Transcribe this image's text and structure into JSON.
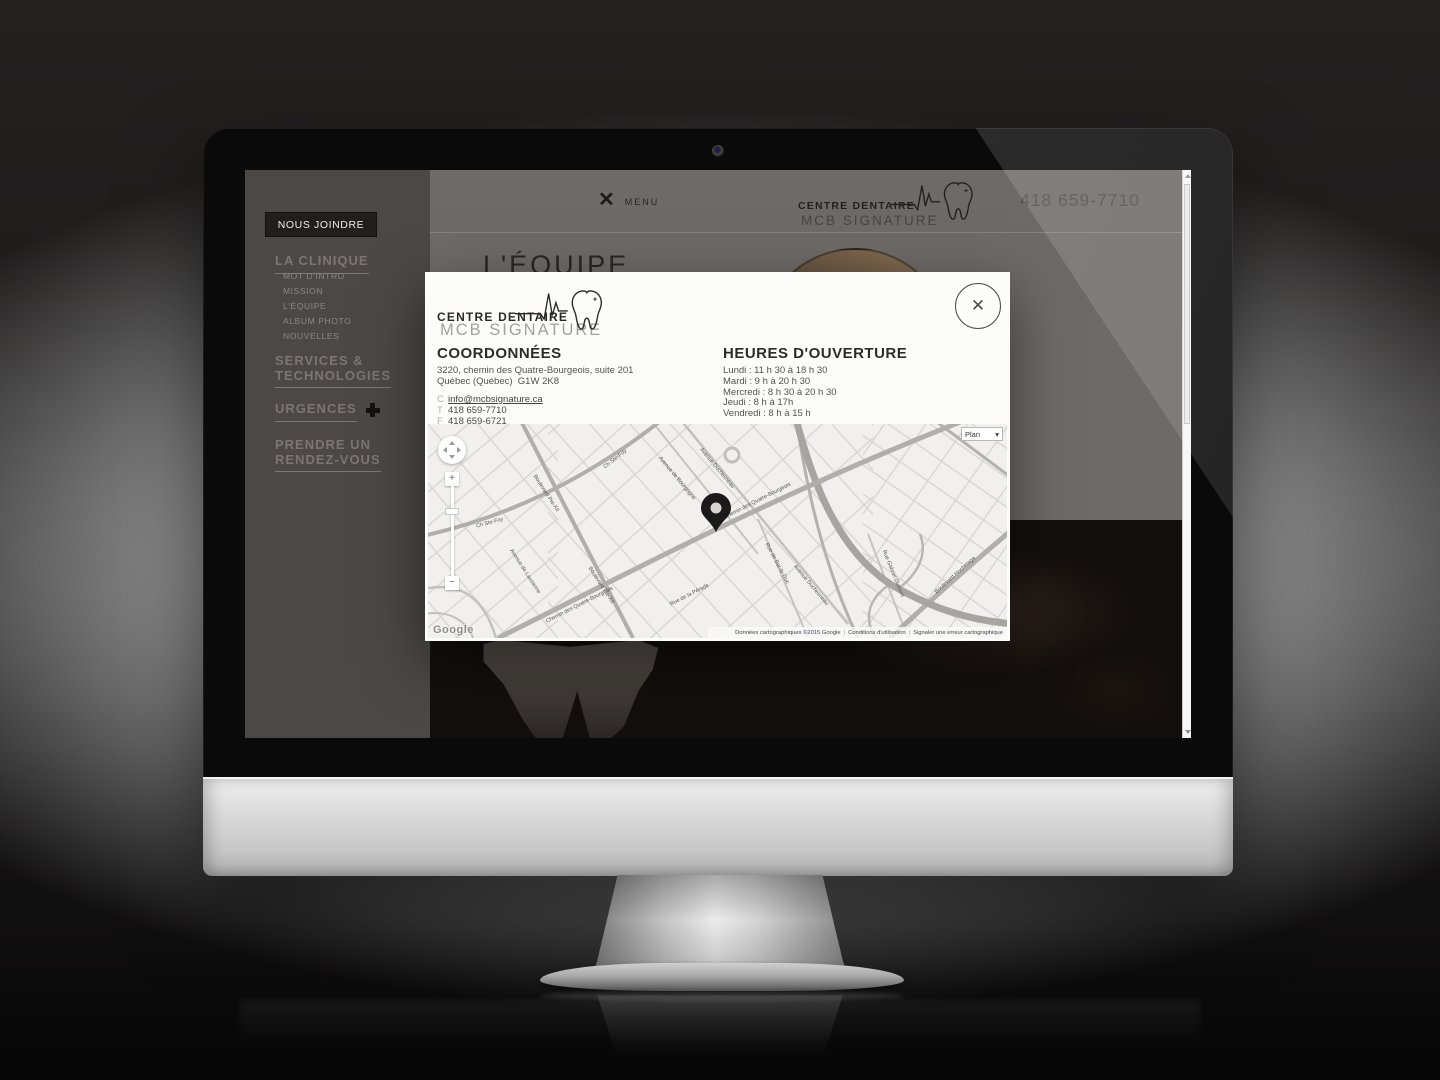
{
  "site": {
    "header": {
      "menu_icon": "✕",
      "menu_label": "MENU",
      "logo": {
        "line1": "CENTRE DENTAIRE",
        "line2": "MCB SIGNATURE"
      },
      "phone": "418 659-7710"
    },
    "sidebar": {
      "active_label": "NOUS JOINDRE",
      "la_clinique": "LA CLINIQUE",
      "sub_items": [
        "MOT D'INTRO",
        "MISSION",
        "L'ÉQUIPE",
        "ALBUM PHOTO",
        "NOUVELLES"
      ],
      "services": "SERVICES &\nTECHNOLOGIES",
      "urgences": "URGENCES",
      "rendezvous": "PRENDRE UN\nRENDEZ-VOUS"
    },
    "page_title": "L'ÉQUIPE"
  },
  "modal": {
    "logo": {
      "line1": "CENTRE DENTAIRE",
      "line2": "MCB SIGNATURE"
    },
    "close_icon": "✕",
    "coordonnees": {
      "title": "COORDONNÉES",
      "address1": "3220, chemin des Quatre-Bourgeois, suite 201",
      "address2": "Québec (Québec)  G1W 2K8",
      "email_label": "C",
      "email": "info@mcbsignature.ca",
      "phone_label": "T",
      "phone": "418 659-7710",
      "fax_label": "F",
      "fax": "418 659-6721"
    },
    "hours": {
      "title": "HEURES D'OUVERTURE",
      "rows": [
        "Lundi : 11 h 30 à 18 h 30",
        "Mardi : 9 h à 20 h 30",
        "Mercredi : 8 h 30 à 20 h 30",
        "Jeudi : 8 h à 17h",
        "Vendredi : 8 h à 15 h"
      ]
    },
    "map": {
      "type_label": "Plan",
      "type_caret": "▾",
      "zoom_in": "+",
      "zoom_out": "−",
      "brand": "Google",
      "attribution1": "Données cartographiques ©2015 Google",
      "attribution2": "Conditions d'utilisation",
      "attribution3": "Signaler une erreur cartographique",
      "sep": "|",
      "streets": [
        "Chemin des Quatre-Bourgeois",
        "Chemin des Quatre-Bourgeois",
        "Ch Ste-Foy",
        "Ch Ste-Foy",
        "Boulevard Pie-XII",
        "Boulevard Pie-XII",
        "Avenue Duchesneau",
        "Avenue Duchesneau",
        "Rue de Bar-le-Duc",
        "Rue Gabriel Dumont",
        "Avenue de Bourgogne",
        "Boulevard Hochelaga",
        "Rue de la Pérade",
        "Avenue de Lausanne"
      ]
    }
  },
  "colors": {
    "sidebar_bg": "#4b4845",
    "page_gray": "#6e6a67",
    "active_box": "#211e1c",
    "modal_bg": "#fcfcfb",
    "map_bg": "#f1f0ee",
    "pin": "#1a1a1a"
  }
}
